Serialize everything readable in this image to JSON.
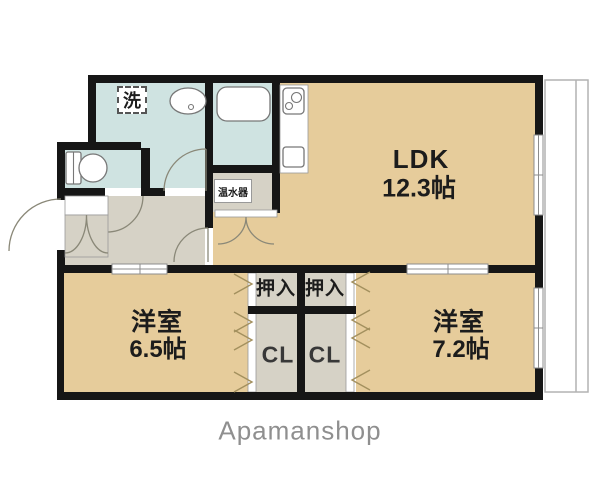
{
  "floorplan": {
    "rooms": {
      "ldk": {
        "name": "LDK",
        "size": "12.3帖"
      },
      "west_room_1": {
        "name": "洋室",
        "size": "6.5帖"
      },
      "west_room_2": {
        "name": "洋室",
        "size": "7.2帖"
      },
      "oshiire_left": "押入",
      "oshiire_right": "押入",
      "closet_left": "CL",
      "closet_right": "CL",
      "water_heater": "温水器",
      "laundry": "洗"
    },
    "watermark": "Apamanshop",
    "colors": {
      "wall": "#161616",
      "tan": "#e6cc9b",
      "blue": "#cfe3e1",
      "gray": "#d6d2c6",
      "outline": "#999999",
      "door": "#8a8878",
      "chev": "#a3905e",
      "bal": "#b2b2b2",
      "wm": "#8f8f8f",
      "text": "#1c1c1c"
    }
  }
}
